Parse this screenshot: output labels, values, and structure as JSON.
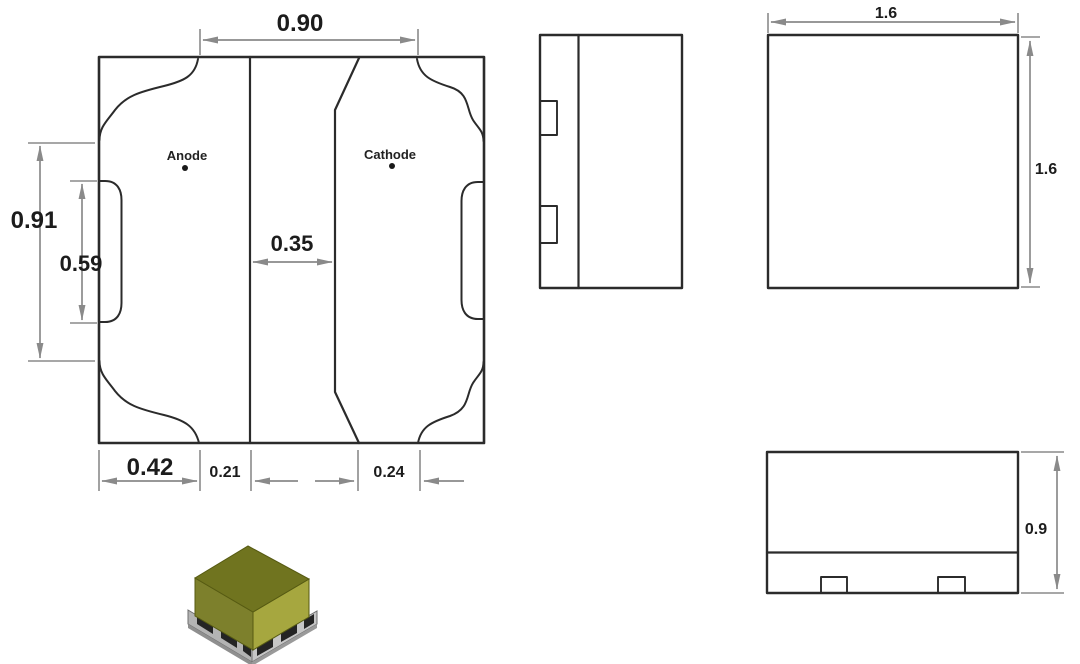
{
  "footprint": {
    "anode_label": "Anode",
    "cathode_label": "Cathode",
    "dims": {
      "top_width": "0.90",
      "outer_height": "0.91",
      "inner_height": "0.59",
      "center_gap": "0.35",
      "anode_width": "0.42",
      "anode_to_center": "0.21",
      "cathode_inset": "0.24"
    }
  },
  "package": {
    "top_view_width": "1.6",
    "top_view_height": "1.6",
    "front_view_height": "0.9"
  },
  "colors": {
    "outline": "#2b2b2b",
    "dimension_line": "#8a8a8a",
    "label_text": "#1c1c1c",
    "led_body_top": "#70741f",
    "led_body_left": "#7d802c",
    "led_body_right": "#a6a73f",
    "led_base_left": "#b3b3b3",
    "led_base_right": "#c6c6c6",
    "led_base_bottom": "#8f8f8f",
    "led_pad": "#242424"
  }
}
